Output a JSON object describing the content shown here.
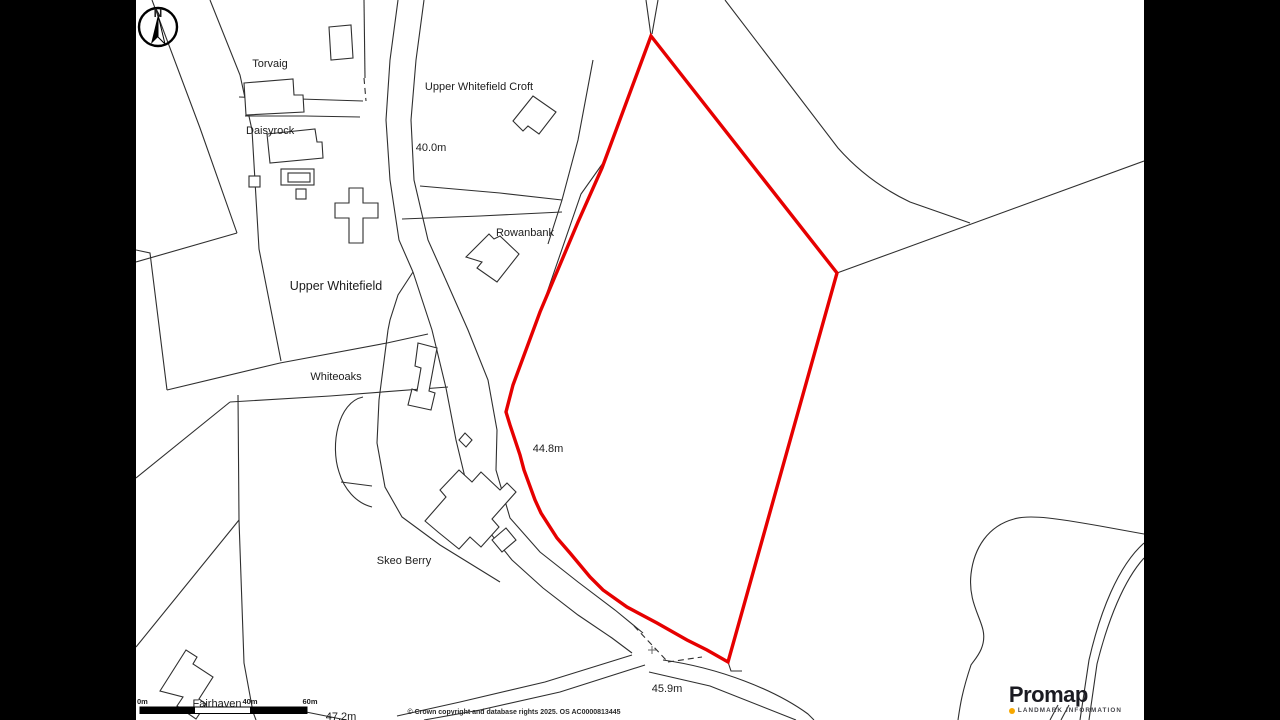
{
  "map": {
    "north_letter": "N",
    "labels": {
      "torvaig": "Torvaig",
      "upper_whitefield_croft": "Upper Whitefield Croft",
      "daisyrock": "Daisyrock",
      "rowanbank": "Rowanbank",
      "upper_whitefield": "Upper Whitefield",
      "whiteoaks": "Whiteoaks",
      "skeo_berry": "Skeo Berry",
      "fairhaven": "Fairhaven"
    },
    "spot_heights": {
      "h1": "40.0m",
      "h2": "44.8m",
      "h3": "45.9m",
      "h4": "47.2m"
    },
    "scale_bar": {
      "labels": [
        "0m",
        "40m",
        "60m"
      ]
    },
    "copyright": "© Crown copyright and database rights 2025. OS AC0000813445",
    "colors": {
      "site_boundary": "#e60000",
      "linework": "#2f2f2f"
    }
  },
  "branding": {
    "name": "Promap",
    "tagline": "LANDMARK INFORMATION",
    "dot_color": "#f7a800"
  }
}
